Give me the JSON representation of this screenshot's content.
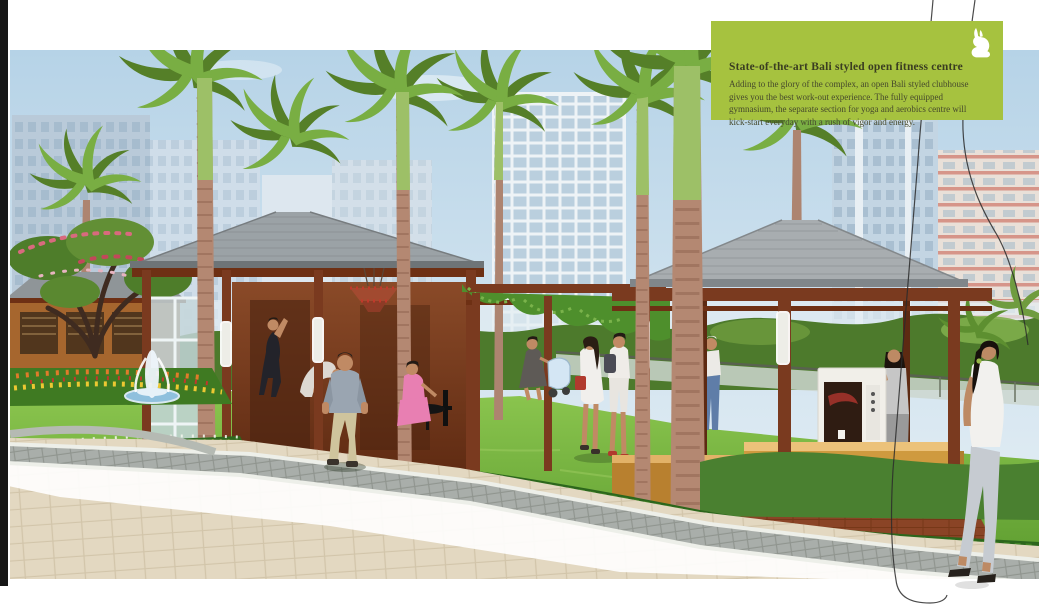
{
  "page": {
    "type": "real-estate brochure page",
    "subject": "Bali styled open-air clubhouse and fitness centre rendering"
  },
  "info_card": {
    "title": "State-of-the-art Bali styled open fitness centre",
    "body": "Adding to the glory of the complex, an open Bali styled clubhouse gives you the best work-out experience. The fully equipped gymnasium, the separate section for yoga and aerobics centre will kick-start everyday with a rush of vigor and energy.",
    "icon": "rabbit-icon",
    "icon_color": "#ffffff"
  },
  "palette": {
    "page_bg": "#ffffff",
    "spine_black": "#161616",
    "card_green": "#a6c23f",
    "card_title": "#3a3d21",
    "card_body": "#46492c",
    "sky_top": "#b6d3e7",
    "sky_bottom": "#e9f1f6",
    "lawn_green": "#7ab33d",
    "hedge_green": "#2e671d",
    "roof_gray": "#9ba2a6",
    "wood_brown": "#7a3a1f",
    "trunk_pink": "#b48872",
    "paver_beige": "#e3d8c1",
    "paver_gray": "#a9aeaa",
    "water_blue": "#8fc0dd",
    "flower_yellow": "#e8de3c",
    "wire_dark": "#2b2b2b"
  }
}
